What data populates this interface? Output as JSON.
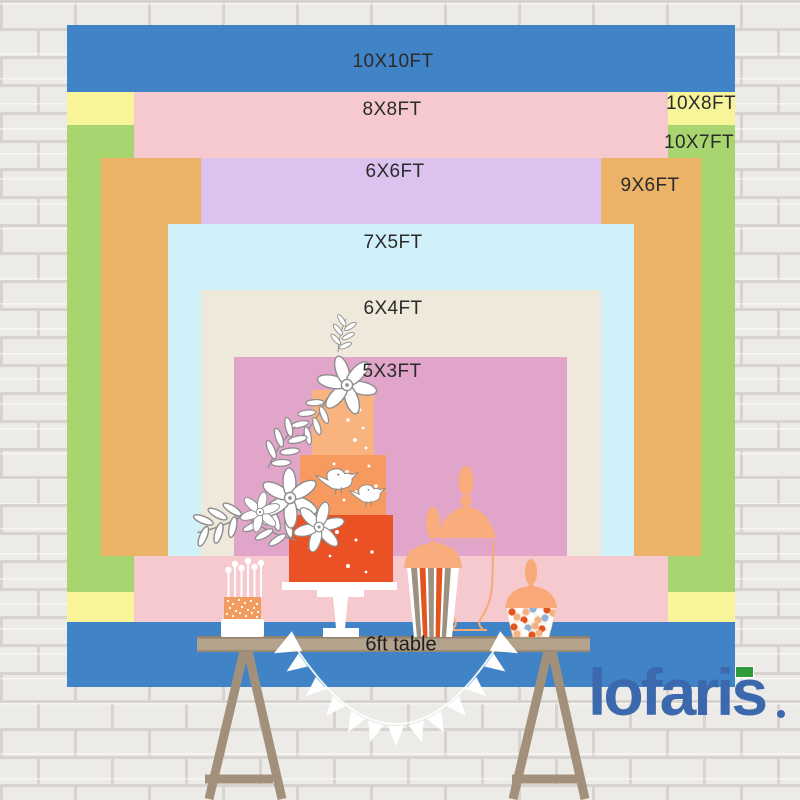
{
  "title": "Backdrop size comparison",
  "sizes": [
    {
      "label": "10X10FT",
      "color": "#4183c7"
    },
    {
      "label": "10X8FT",
      "color": "#f8f49a"
    },
    {
      "label": "10X7FT",
      "color": "#a8d56f"
    },
    {
      "label": "8X8FT",
      "color": "#f5c9ce"
    },
    {
      "label": "9X6FT",
      "color": "#ecb268"
    },
    {
      "label": "6X6FT",
      "color": "#dcc3ef"
    },
    {
      "label": "7X5FT",
      "color": "#d0f0fa"
    },
    {
      "label": "6X4FT",
      "color": "#eee9da"
    },
    {
      "label": "5X3FT",
      "color": "#e1a5c9"
    }
  ],
  "table": {
    "label": "6ft table",
    "top_color": "#b3a28c",
    "leg_color": "#a2907a"
  },
  "brand": {
    "logo_text": "lofaris",
    "logo_color": "#3c69ae",
    "badge_color": "#2f9b3a"
  },
  "palette": {
    "wall": "#edebe8",
    "mortar": "#d7d3cf",
    "cake_tiers": [
      "#f9b37e",
      "#f69a5f",
      "#ea5226"
    ],
    "peach": "#f9ad7c",
    "accent_orange": "#e2551f",
    "stripe_gray": "#9d9181",
    "candy_blue": "#8fb0d8"
  },
  "decor_icons": [
    "brick-wall",
    "wedding-cake",
    "cake-stand",
    "mini-cake-with-candles",
    "popcorn-jar",
    "glass-candy-jar",
    "apothecary-jar-outline",
    "dessert-table",
    "bunting-garland",
    "flower",
    "bird"
  ]
}
